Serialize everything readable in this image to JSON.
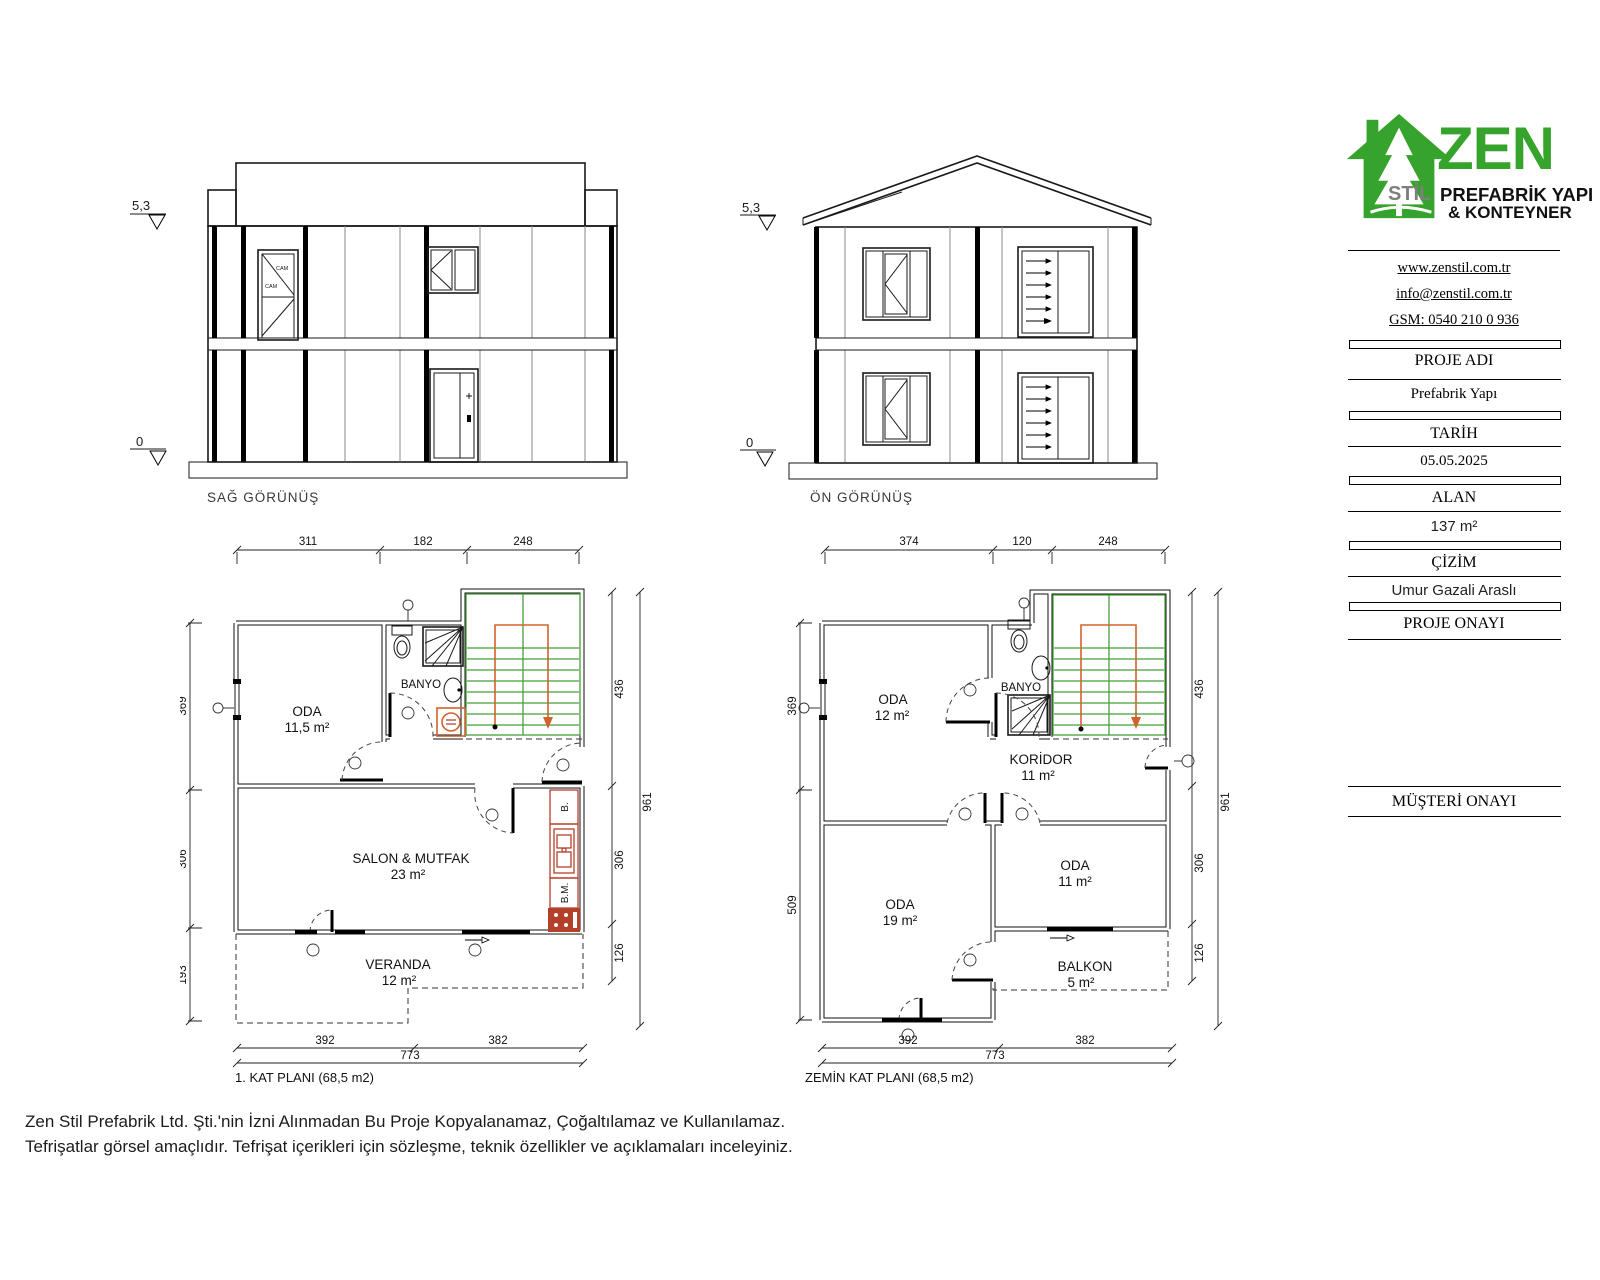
{
  "colors": {
    "brand_green": "#36a32c",
    "stair_green": "#44a038",
    "path_orange": "#d2622d",
    "fixture_red": "#b5402a"
  },
  "brand": {
    "name": "ZEN",
    "sub": "STİL",
    "line1": "PREFABRİK YAPI",
    "line2": "& KONTEYNER",
    "website": "www.zenstil.com.tr",
    "email": "info@zenstil.com.tr",
    "gsm": "GSM: 0540 210 0 936"
  },
  "fields": {
    "proje_adi_label": "PROJE ADI",
    "proje_adi_value": "Prefabrik Yapı",
    "tarih_label": "TARİH",
    "tarih_value": "05.05.2025",
    "alan_label": "ALAN",
    "alan_value": "137 m²",
    "cizim_label": "ÇİZİM",
    "cizim_value": "Umur Gazali Araslı",
    "proje_onayi_label": "PROJE ONAYI",
    "musteri_onayi_label": "MÜŞTERİ ONAYI"
  },
  "elevations": {
    "right": {
      "title": "SAĞ GÖRÜNÜŞ",
      "level_top": "5,3",
      "level_bottom": "0",
      "glass_label": "CAM"
    },
    "front": {
      "title": "ÖN GÖRÜNÜŞ",
      "level_top": "5,3",
      "level_bottom": "0"
    }
  },
  "plan1": {
    "title": "1. KAT PLANI (68,5 m2)",
    "rooms": {
      "oda": {
        "name": "ODA",
        "area": "11,5 m²"
      },
      "banyo": {
        "name": "BANYO"
      },
      "salon": {
        "name": "SALON & MUTFAK",
        "area": "23 m²"
      },
      "veranda": {
        "name": "VERANDA",
        "area": "12 m²"
      }
    },
    "kitchen": {
      "fridge": "B.",
      "dishwasher": "B.M."
    },
    "dims": {
      "top": [
        "311",
        "182",
        "248"
      ],
      "left": [
        "369",
        "306",
        "193"
      ],
      "right": [
        "436",
        "306",
        "126"
      ],
      "right_total": "961",
      "bottom": [
        "392",
        "382"
      ],
      "bottom_total": "773"
    }
  },
  "plan2": {
    "title": "ZEMİN KAT PLANI (68,5 m2)",
    "rooms": {
      "oda1": {
        "name": "ODA",
        "area": "12 m²"
      },
      "banyo": {
        "name": "BANYO"
      },
      "koridor": {
        "name": "KORİDOR",
        "area": "11 m²"
      },
      "oda2": {
        "name": "ODA",
        "area": "19 m²"
      },
      "oda3": {
        "name": "ODA",
        "area": "11 m²"
      },
      "balkon": {
        "name": "BALKON",
        "area": "5 m²"
      }
    },
    "dims": {
      "top": [
        "374",
        "120",
        "248"
      ],
      "left": [
        "369",
        "509"
      ],
      "right": [
        "436",
        "306",
        "126"
      ],
      "right_total": "961",
      "bottom": [
        "392",
        "382"
      ],
      "bottom_total": "773"
    }
  },
  "footer": {
    "line1": "Zen Stil Prefabrik Ltd. Şti.'nin İzni Alınmadan Bu Proje Kopyalanamaz, Çoğaltılamaz ve Kullanılamaz.",
    "line2": "Tefrişatlar görsel amaçlıdır. Tefrişat içerikleri için sözleşme, teknik özellikler ve açıklamaları inceleyiniz."
  }
}
